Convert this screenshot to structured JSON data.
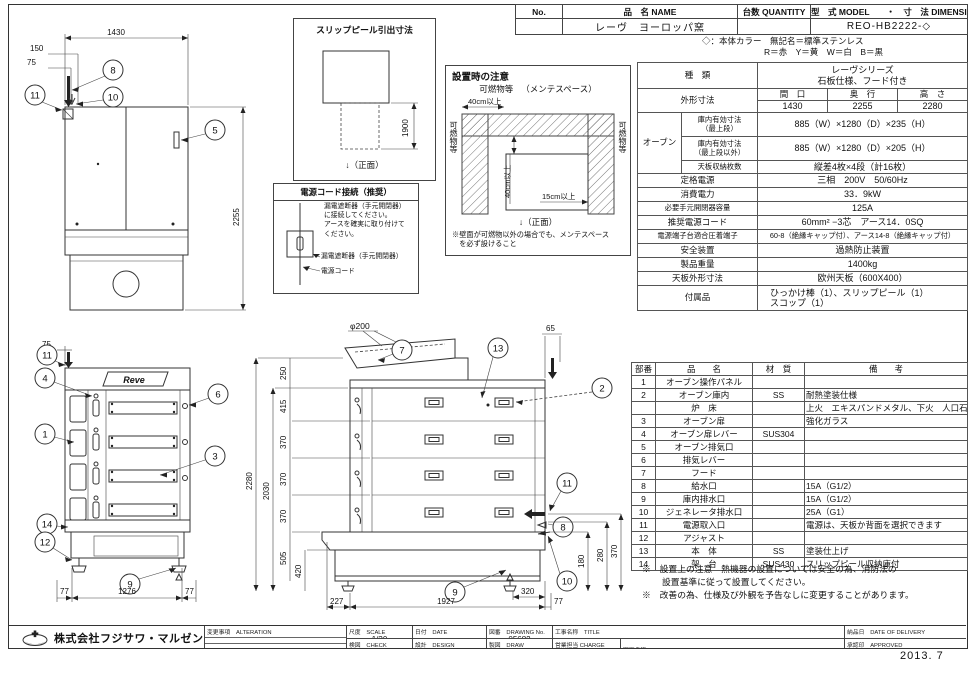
{
  "header": {
    "no_label": "No.",
    "name_label": "品　名 NAME",
    "qty_label": "台数 QUANTITY",
    "model_label": "型　式 MODEL　　・　寸　法 DIMENSION",
    "name_value": "レーヴ　ヨーロッパ窯",
    "model_value": "REO-HB2222-◇"
  },
  "color_note": {
    "line1": "◇：本体カラー　無記名＝標準ステンレス",
    "line2": "R＝赤　Y＝黄　W＝白　B＝黒"
  },
  "spec": {
    "kind_label": "種　類",
    "kind_v1": "レーヴシリーズ",
    "kind_v2": "石板仕様、フード付き",
    "outer_label": "外形寸法",
    "w_h": "間　口",
    "d_h": "奥　行",
    "h_h": "高　さ",
    "w": "1430",
    "d": "2255",
    "h": "2280",
    "oven_label": "オーブン",
    "in1_l1": "庫内有効寸法",
    "in1_l2": "（最上段）",
    "in1_v": "885（W）×1280（D）×235（H）",
    "in2_l1": "庫内有効寸法",
    "in2_l2": "（最上段以外）",
    "in2_v": "885（W）×1280（D）×205（H）",
    "trays_label": "天板収納枚数",
    "trays_v": "縦差4枚×4段（計16枚）",
    "power_label": "定格電源",
    "power_v": "三相　200V　50/60Hz",
    "cons_label": "消費電力",
    "cons_v": "33．9kW",
    "breaker_label": "必要手元開閉器容量",
    "breaker_v": "125A",
    "cord_label": "推奨電源コード",
    "cord_v": "60mm² −3芯　アース14．0SQ",
    "term_label": "電源端子台適合圧着端子",
    "term_v": "60-8（絶縁キャップ付）、アース14-8（絶縁キャップ付）",
    "safety_label": "安全装置",
    "safety_v": "過熱防止装置",
    "weight_label": "製品重量",
    "weight_v": "1400kg",
    "tray_label": "天板外形寸法",
    "tray_v": "欧州天板（600X400）",
    "acc_label": "付属品",
    "acc_v1": "ひっかけ棒（1）、スリップピール（1）",
    "acc_v2": "スコップ（1）"
  },
  "parts": {
    "headers": {
      "no": "部番",
      "name": "品　　名",
      "material": "材　質",
      "note": "備　　考"
    },
    "rows": [
      {
        "no": "1",
        "name": "オーブン操作パネル",
        "material": "",
        "note": ""
      },
      {
        "no": "2",
        "name": "オーブン庫内",
        "material": "SS",
        "note": "耐熱塗装仕様"
      },
      {
        "no": "",
        "name": "炉　床",
        "material": "",
        "note": "上火　エキスパンドメタル、下火　人口石ボード"
      },
      {
        "no": "3",
        "name": "オーブン扉",
        "material": "",
        "note": "強化ガラス"
      },
      {
        "no": "4",
        "name": "オーブン扉レバー",
        "material": "SUS304",
        "note": ""
      },
      {
        "no": "5",
        "name": "オーブン排気口",
        "material": "",
        "note": ""
      },
      {
        "no": "6",
        "name": "排気レバー",
        "material": "",
        "note": ""
      },
      {
        "no": "7",
        "name": "フード",
        "material": "",
        "note": ""
      },
      {
        "no": "8",
        "name": "給水口",
        "material": "",
        "note": "15A（G1/2）"
      },
      {
        "no": "9",
        "name": "庫内排水口",
        "material": "",
        "note": "15A（G1/2）"
      },
      {
        "no": "10",
        "name": "ジェネレータ排水口",
        "material": "",
        "note": "25A（G1）"
      },
      {
        "no": "11",
        "name": "電源取入口",
        "material": "",
        "note": "電源は、天板か背面を選択できます"
      },
      {
        "no": "12",
        "name": "アジャスト",
        "material": "",
        "note": ""
      },
      {
        "no": "13",
        "name": "本　体",
        "material": "SS",
        "note": "塗装仕上げ"
      },
      {
        "no": "14",
        "name": "架　台",
        "material": "SUS430",
        "note": "スリップピール収納庫付"
      }
    ]
  },
  "notes": {
    "line1": "※　設置上の注意　熱機器の設置については安全の為、消防法の",
    "line2": "設置基準に従って設置してください。",
    "line3": "※　改善の為、仕様及び外観を予告なしに変更することがあります。"
  },
  "slip_peel": {
    "title": "スリップピール引出寸法",
    "dim": "1900",
    "front": "↓（正面）"
  },
  "install": {
    "title": "設置時の注意",
    "combustible_top": "可燃物等",
    "maintenance": "（メンテスペース）",
    "top_clearance": "40cm以上",
    "left_label": "可燃物等",
    "right_label": "可燃物等",
    "back_clearance": "40cm以上",
    "side_clearance": "15cm以上",
    "front": "↓（正面）",
    "fn1": "※壁面が可燃物以外の場合でも、メンテスペース",
    "fn2": "　を必ず設けること"
  },
  "power": {
    "title": "電源コード接続（推奨）",
    "t1": "漏電遮断器（手元開閉器）",
    "t2": "に接続してください。",
    "t3": "アースを確実に取り付けて",
    "t4": "ください。",
    "breaker": "漏電遮断器（手元開閉器）",
    "cord": "電源コード"
  },
  "plan_view": {
    "dims": {
      "w": "1430",
      "o150": "150",
      "o75": "75",
      "depth": "2255"
    },
    "callouts": {
      "c8": "8",
      "c10": "10",
      "c11": "11",
      "c5": "5"
    }
  },
  "front_view": {
    "logo": "Reve",
    "dims": {
      "top": "75",
      "bl": "77",
      "bm": "1276",
      "br": "77"
    },
    "callouts": {
      "c11": "11",
      "c4": "4",
      "c1": "1",
      "c14": "14",
      "c12": "12",
      "c6": "6",
      "c3": "3",
      "c9": "9"
    }
  },
  "side_view": {
    "dims": {
      "phi": "φ200",
      "t65": "65",
      "h250": "250",
      "h415": "415",
      "h370a": "370",
      "h370b": "370",
      "h370c": "370",
      "h2280": "2280",
      "h2030": "2030",
      "h505": "505",
      "h420": "420",
      "r370": "370",
      "r280": "280",
      "r180": "180",
      "r320": "320",
      "b227": "227",
      "b1927": "1927",
      "b77": "77"
    },
    "callouts": {
      "c7": "7",
      "c13": "13",
      "c2": "2",
      "c11": "11",
      "c8": "8",
      "c10": "10",
      "c9": "9"
    }
  },
  "title_block": {
    "company": "株式会社フジサワ・マルゼン",
    "alteration_label": "変更事項　ALTERATION",
    "scale_label": "尺度　SCALE",
    "scale_value": "1/30",
    "date_label": "日付　DATE",
    "date_value": "・　　・",
    "dwgno_label": "図番　DRAWING No.",
    "dwgno_value": "05682",
    "title_label": "工事名称　TITLE",
    "delivery_label": "納品日　DATE OF DELIVERY",
    "check_label": "検図　CHECK",
    "design_label": "設計　DESIGN",
    "draw_label": "製図　DRAW",
    "charge_label": "営業担当 CHARGE",
    "dwgname_label": "図面名称　DRAWING CORD",
    "dwgname_value": "レーヴ　ヨーロッパ窯",
    "approved_label": "承認印　APPROVED"
  },
  "footer": {
    "date_stamp": "2013. 7"
  }
}
